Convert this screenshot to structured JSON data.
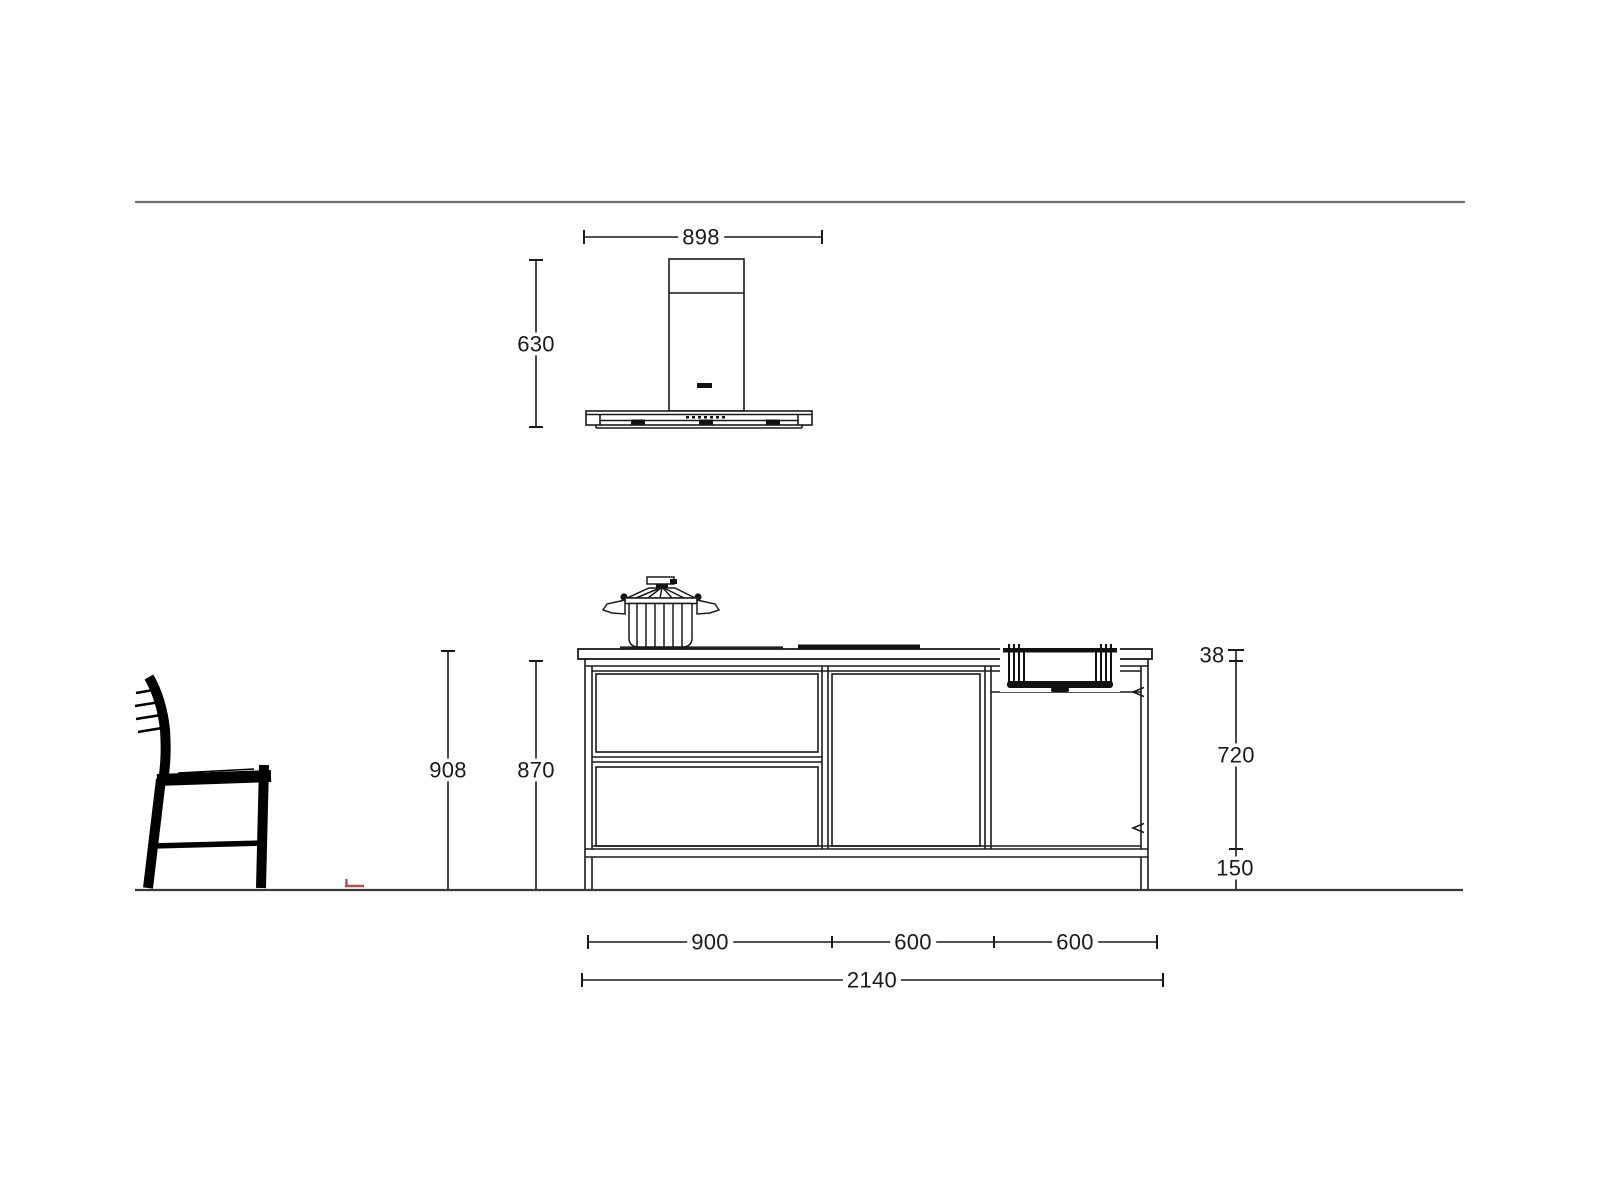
{
  "drawing_title": "kitchen-island-elevation",
  "dimensions": {
    "hood": {
      "width": "898",
      "height": "630"
    },
    "heights": {
      "overall": "908",
      "worktop": "870"
    },
    "right_chain": {
      "worktop_thickness": "38",
      "carcass": "720",
      "plinth": "150"
    },
    "widths": {
      "sections": [
        "900",
        "600",
        "600"
      ],
      "overall": "2140"
    }
  },
  "colors": {
    "line": "#1a1a1a",
    "reference_line_top": "#707070",
    "ground_line": "#3a3a3a",
    "fill_dark": "#111111",
    "accent_mark": "#a1413d"
  }
}
